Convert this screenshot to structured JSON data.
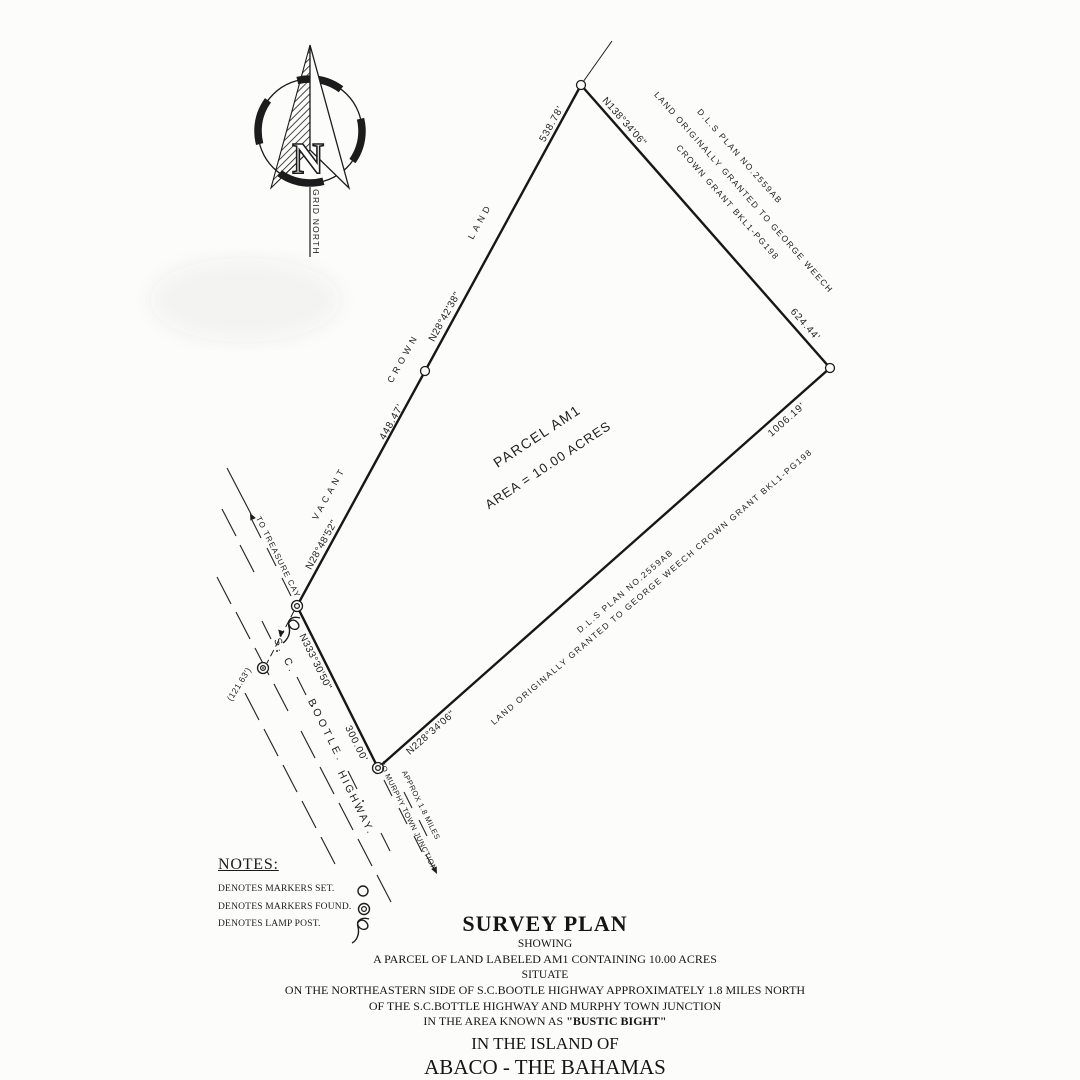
{
  "compass": {
    "cardinal": "N",
    "label": "GRID NORTH"
  },
  "parcel": {
    "name": "PARCEL AM1",
    "area": "AREA =  10.00 ACRES"
  },
  "courses": {
    "west_upper_distance": "538.78'",
    "west_upper_bearing": "N28°42'38\"",
    "west_lower_distance": "448.47'",
    "west_lower_bearing": "N28°48'52\"",
    "northeast_bearing": "N138°34'06\"",
    "northeast_distance": "624.44'",
    "southeast_distance": "1006.19'",
    "southeast_bearing": "N228°34'06\"",
    "southwest_bearing": "N333°30'50\"",
    "southwest_distance": "300.00'",
    "lamp_tie_distance": "(121.63')"
  },
  "adjoiners": {
    "vacant": "VACANT",
    "crown": "CROWN",
    "land": "LAND",
    "ne_line1": "D.L.S PLAN NO.2559AB",
    "ne_line2": "LAND ORIGINALLY GRANTED TO GEORGE WEECH",
    "ne_line3": "CROWN GRANT BKL1-PG198",
    "se_line1": "D.L.S PLAN NO.2559AB",
    "se_line2": "LAND ORIGINALLY GRANTED TO GEORGE WEECH CROWN GRANT BKL1-PG198"
  },
  "highway": {
    "part1": "S. C.",
    "part2": "BOOTLE.",
    "part3": "HIGHWAY.",
    "treasure": "TO TREASURE CAY",
    "murphy": "TO MURPHY TOWN JUNCTION",
    "approx": "APPROX 1.8 MILES"
  },
  "notes": {
    "title": "NOTES:",
    "set": "DENOTES MARKERS  SET.",
    "found": "DENOTES MARKERS FOUND.",
    "lamp": "DENOTES LAMP POST."
  },
  "legend_symbols": {
    "set": "open-circle",
    "found": "double-circle",
    "lamp": "lamp-post-squiggle"
  },
  "title_block": {
    "title": "SURVEY PLAN",
    "showing": "SHOWING",
    "line1": "A PARCEL OF LAND LABELED AM1 CONTAINING 10.00 ACRES",
    "situate": "SITUATE",
    "line2": "ON THE NORTHEASTERN  SIDE OF S.C.BOOTLE HIGHWAY APPROXIMATELY 1.8 MILES NORTH",
    "line3": "OF THE S.C.BOTTLE HIGHWAY AND MURPHY TOWN JUNCTION",
    "line4_prefix": "IN THE AREA KNOWN AS ",
    "line4_bold": "\"BUSTIC BIGHT\"",
    "island": "IN THE ISLAND OF",
    "place": "ABACO - THE BAHAMAS"
  },
  "colors": {
    "ink": "#1c1c1c",
    "paper": "#fcfcfb"
  }
}
